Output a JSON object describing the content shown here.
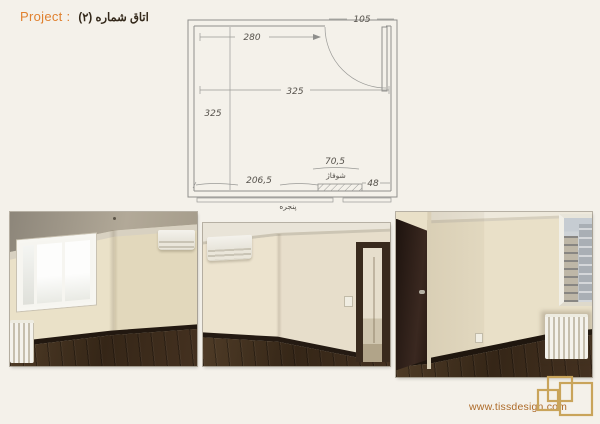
{
  "header": {
    "project_label": "Project :",
    "room_title": "اتاق شماره (۲)"
  },
  "plan": {
    "dim_top_width": "280",
    "dim_door": "105",
    "dim_inner_width": "325",
    "dim_inner_height": "325",
    "dim_bottom_left": "206,5",
    "dim_radiator_width": "70,5",
    "dim_right_gap": "48",
    "label_radiator": "شوفاژ",
    "label_window": "پنجره"
  },
  "photos": [
    {
      "description": "empty room corner with triple window, radiator and air conditioner"
    },
    {
      "description": "empty room corner with air conditioner and open doorway to hallway"
    },
    {
      "description": "empty room with dark wooden door, window with city view and radiator"
    }
  ],
  "footer": {
    "website": "www.tissdesign.com"
  },
  "colors": {
    "background": "#f4f1ea",
    "accent_orange": "#e0812f",
    "title_text": "#33281a",
    "url_text": "#ad6a28",
    "logo_gold": "#c9a45a",
    "pencil": "#8f8f8c",
    "floor_brown": "#43301e",
    "wall_cream": "#e7decb"
  }
}
